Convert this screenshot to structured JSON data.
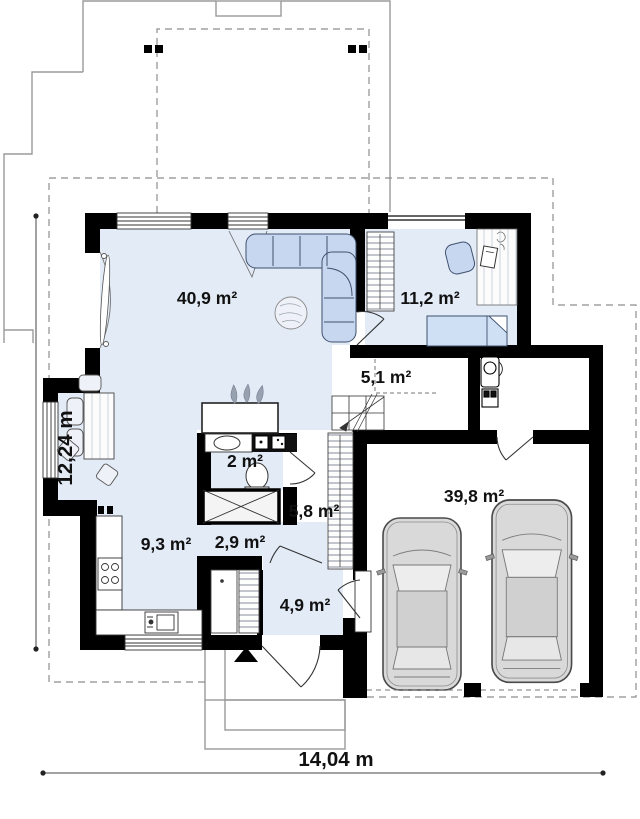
{
  "plan": {
    "type": "house-floor-plan",
    "rooms": [
      {
        "name": "living-room",
        "area_label": "40,9 m²"
      },
      {
        "name": "bedroom",
        "area_label": "11,2 m²"
      },
      {
        "name": "stair-hall",
        "area_label": "5,1 m²"
      },
      {
        "name": "wc",
        "area_label": "2 m²"
      },
      {
        "name": "hall",
        "area_label": "5,8 m²"
      },
      {
        "name": "corridor",
        "area_label": "2,9 m²"
      },
      {
        "name": "kitchen",
        "area_label": "9,3 m²"
      },
      {
        "name": "entry",
        "area_label": "4,9 m²"
      },
      {
        "name": "garage",
        "area_label": "39,8 m²"
      }
    ],
    "dimensions": {
      "vertical": "12,24 m",
      "horizontal": "14,04 m"
    },
    "colors": {
      "wall": "#000000",
      "room_fill": "#e3ebf7",
      "furniture_fill": "#c7d7f0",
      "car_fill": "#d9d9d9",
      "outline_gray": "#9a9a9a"
    }
  }
}
